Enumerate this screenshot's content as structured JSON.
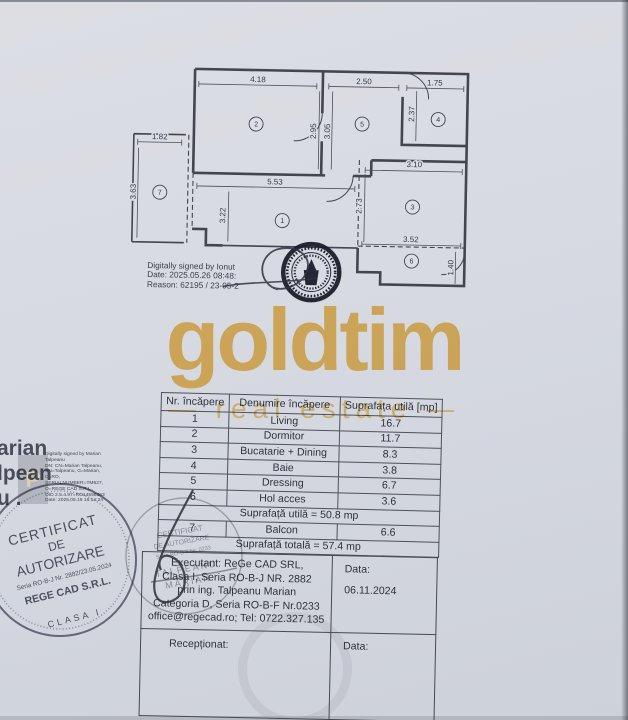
{
  "colors": {
    "brand_gold": "#f1b94e",
    "paper": "#d7dae1",
    "ink": "#2f333d",
    "stamp_ink": "#5e5e6e",
    "seal_ink": "#181826"
  },
  "watermark": {
    "brand": "goldtim",
    "tagline": "— real estate —"
  },
  "plan": {
    "dims": [
      {
        "label": "4.18",
        "x": 131,
        "y": 28,
        "rot": 0
      },
      {
        "label": "2.50",
        "x": 237,
        "y": 28,
        "rot": 0
      },
      {
        "label": "1.75",
        "x": 308,
        "y": 28,
        "rot": 0
      },
      {
        "label": "2.95",
        "x": 190,
        "y": 76,
        "rot": -90
      },
      {
        "label": "3.05",
        "x": 204,
        "y": 76,
        "rot": -90
      },
      {
        "label": "2.37",
        "x": 288,
        "y": 57,
        "rot": -90
      },
      {
        "label": "3.10",
        "x": 289,
        "y": 110,
        "rot": 0
      },
      {
        "label": "2.73",
        "x": 237,
        "y": 150,
        "rot": -90
      },
      {
        "label": "5.53",
        "x": 150,
        "y": 130,
        "rot": 0
      },
      {
        "label": "3.22",
        "x": 101,
        "y": 162,
        "rot": -90
      },
      {
        "label": "3.52",
        "x": 287,
        "y": 185,
        "rot": 0
      },
      {
        "label": "1.40",
        "x": 330,
        "y": 210,
        "rot": -90
      },
      {
        "label": "1.82",
        "x": 34,
        "y": 87,
        "rot": 0
      },
      {
        "label": "3.63",
        "x": 11,
        "y": 140,
        "rot": -90
      }
    ],
    "rooms": [
      {
        "num": "1",
        "x": 158,
        "y": 166
      },
      {
        "num": "2",
        "x": 130,
        "y": 70
      },
      {
        "num": "3",
        "x": 288,
        "y": 150
      },
      {
        "num": "4",
        "x": 312,
        "y": 62
      },
      {
        "num": "5",
        "x": 236,
        "y": 68
      },
      {
        "num": "6",
        "x": 288,
        "y": 204
      },
      {
        "num": "7",
        "x": 35,
        "y": 140
      }
    ],
    "signature_lines": [
      "Digitally signed by Ionut",
      "Date: 2025.05.26 08:48:",
      "Reason: 62195 / 23-05-2"
    ]
  },
  "area_table": {
    "headers": [
      "Nr. încăpere",
      "Denumire încăpere",
      "Suprafața utilă [mp]"
    ],
    "rows": [
      {
        "nr": "1",
        "name": "Living",
        "area": "16.7"
      },
      {
        "nr": "2",
        "name": "Dormitor",
        "area": "11.7"
      },
      {
        "nr": "3",
        "name": "Bucatarie + Dining",
        "area": "8.3"
      },
      {
        "nr": "4",
        "name": "Baie",
        "area": "3.8"
      },
      {
        "nr": "5",
        "name": "Dressing",
        "area": "6.7"
      },
      {
        "nr": "6",
        "name": "Hol acces",
        "area": "3.6"
      },
      {
        "span": "Suprafață utilă = 50.8 mp"
      },
      {
        "nr": "7",
        "name": "Balcon",
        "area": "6.6"
      },
      {
        "span": "Suprafață totală = 57.4 mp"
      }
    ]
  },
  "footer": {
    "executant_lines": [
      "Executant: ReGe CAD SRL,",
      "Clasa I, Seria RO-B-J NR. 2882",
      "prin ing. Talpeanu Marian",
      "Categoria D, Seria RO-B-F Nr.0233",
      "office@regecad.ro; Tel: 0722.327.135"
    ],
    "data_label": "Data:",
    "data_value": "06.11.2024",
    "receptionat_label": "Recepționat:",
    "data_label_2": "Data:"
  },
  "left_signature": {
    "big_lines": [
      "arian",
      "lpean",
      "u ."
    ],
    "badge_letter": "P",
    "detail_lines": [
      "Digitally signed by Marian",
      "Talpeanu",
      "DN: CN=Marian Talpeanu,",
      "SN=Talpeanu, G=Marian,",
      "C=RO,",
      "SERIALNUMBER=TM627,",
      "O=REGE CAD S.R.L.,",
      "OID 2.5.4.97=RO14598363",
      "Date: 2025.05.15 16:14:24"
    ]
  },
  "stamps": {
    "authorization": {
      "title1": "CERTIFICAT",
      "title2": "DE",
      "title3": "AUTORIZARE",
      "serial": "Seria RO-B-J Nr. 2882/23.05.2024",
      "company": "REGE CAD S.R.L.",
      "clasa": "CLASA I"
    },
    "personal": {
      "title1": "CERTIFICAT",
      "title2": "DE AUTORIZARE",
      "serial": "Seria RO-B-F Nr. 0233",
      "name1": "TALPEANU",
      "name2": "MARIAN"
    }
  }
}
